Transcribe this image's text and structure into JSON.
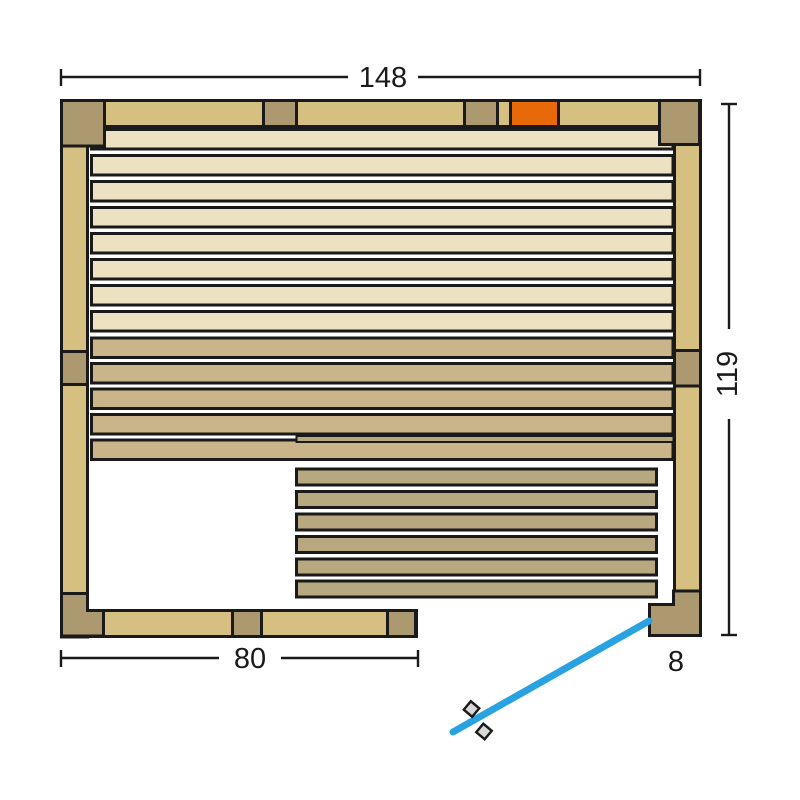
{
  "figure": {
    "type": "floor-plan",
    "subject": "sauna cabin top view with benches, heater and door swing"
  },
  "dimensions": {
    "overall_width": "148",
    "overall_depth": "119",
    "bench_length": "80",
    "door_frame": "8"
  },
  "counts": {
    "upper_wall_planks": 8,
    "lower_wall_planks": 5,
    "bench_planks": 6,
    "door_handles": 2
  },
  "colors": {
    "wall_light": "#d5bf81",
    "wall_dark": "#ad9970",
    "plank_light": "#ece1c0",
    "plank_medium": "#cab58b",
    "bench_plank": "#b8a880",
    "heater": "#e8690a",
    "door_swing": "#29a2e2",
    "handle_fill": "#d9d9d9",
    "outline": "#1a1a1a"
  }
}
